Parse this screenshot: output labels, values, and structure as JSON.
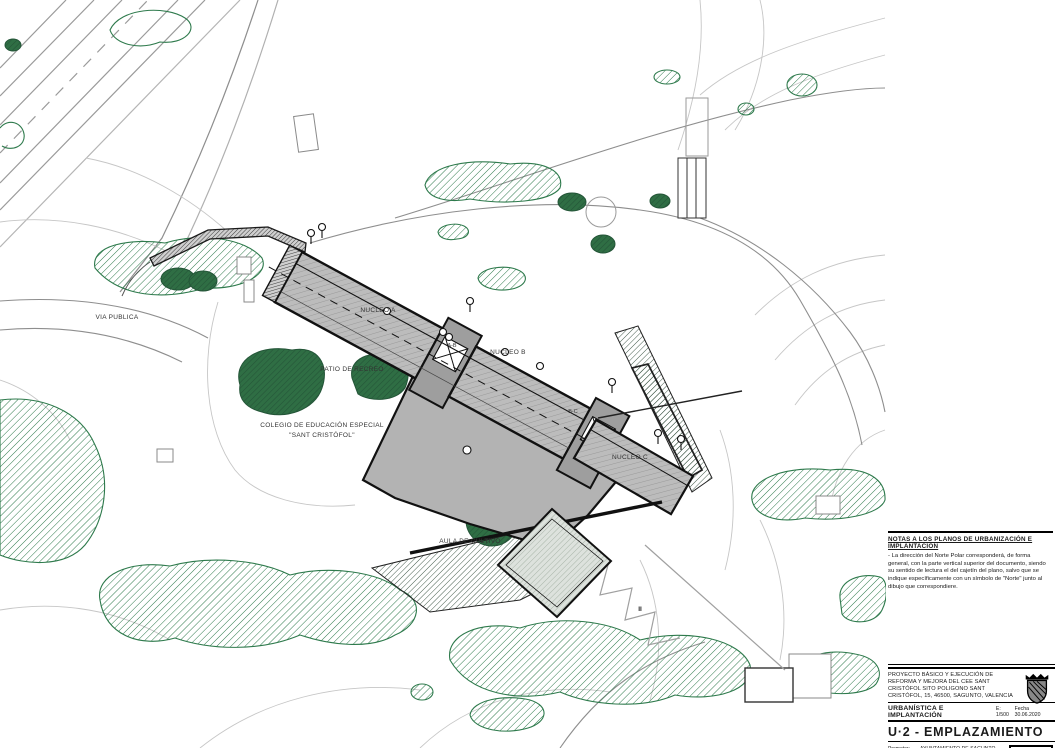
{
  "sheet": {
    "kind": "architectural site plan",
    "colors": {
      "tree_green": "#2d6a41",
      "hatch_green": "#2e7a4c",
      "building_gray": "#bcbcbc",
      "plaza_gray": "#b3b3b3",
      "connector_gray": "#9e9e9e",
      "contour_gray": "#c6c6c6",
      "line_black": "#1a1a1a"
    }
  },
  "plan": {
    "labels": {
      "via_publica": "VIA PUBLICA",
      "patio": "PATIO DE RECREO",
      "colegio_line1": "COLEGIO DE EDUCACIÓN ESPECIAL",
      "colegio_line2": "\"SANT CRISTÓFOL\"",
      "nucleo_a": "NUCLEO A",
      "nucleo_b": "NUCLEO B",
      "nucleo_c": "NUCLEO C",
      "link_ab": "A-B",
      "link_bc": "B-C",
      "aula": "AULA DE CULTIVO",
      "height_marker": "II"
    }
  },
  "notes": {
    "title": "NOTAS A LOS PLANOS DE URBANIZACIÓN E IMPLANTACIÓN",
    "body": "- La dirección del Norte Polar corresponderá, de forma general, con la parte vertical superior del documento, siendo su sentido de lectura el del cajetín del plano, salvo que se indique específicamente con un símbolo de \"Norte\" junto al dibujo que correspondiere."
  },
  "titleblock": {
    "project": "PROYECTO BÁSICO Y EJECUCIÓN DE REFORMA Y MEJORA DEL CEE SANT CRISTÓFOL SITO POLIGONO SANT CRISTÓFOL, 15, 46500, SAGUNTO, VALENCIA",
    "discipline": "URBANÍSTICA E IMPLANTACIÓN",
    "scale": "E: 1/500",
    "date": "Fecha 30.06.2020",
    "sheet_code": "U·2 - EMPLAZAMIENTO",
    "promoter_label": "Promotor:",
    "promoter": "AYUNTAMIENTO DE SAGUNTO CIF.: P-4622200-F",
    "architects_label": "Arquitectos:",
    "architects": "MARIO CASADO - CONCHI"
  }
}
